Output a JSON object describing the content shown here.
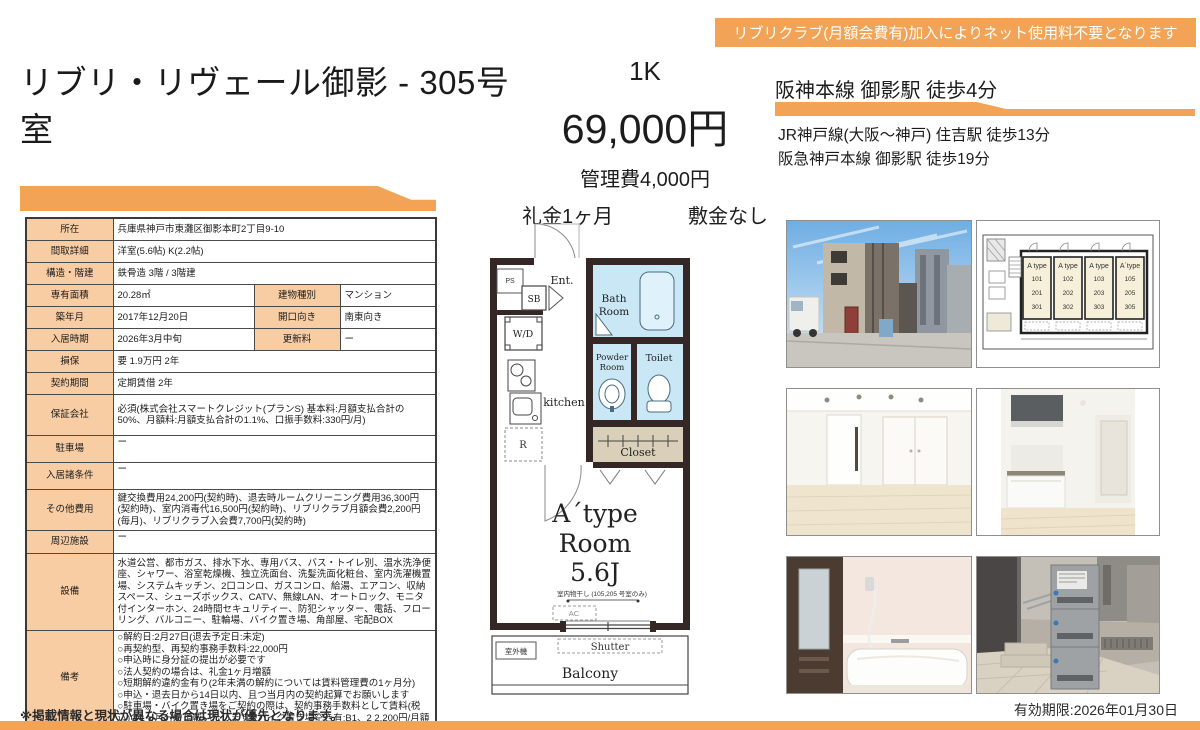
{
  "banner": {
    "text": "リブリクラブ(月額会費有)加入によりネット使用料不要となります"
  },
  "header": {
    "title": "リブリ・リヴェール御影 - 305号室",
    "layout_type": "1K",
    "rent": "69,000円",
    "management_fee": "管理費4,000円",
    "key_money": "礼金1ヶ月",
    "deposit": "敷金なし",
    "access_main": "阪神本線 御影駅 徒歩4分",
    "access_sub": [
      "JR神戸線(大阪〜神戸) 住吉駅 徒歩13分",
      "阪急神戸本線 御影駅 徒歩19分"
    ]
  },
  "table": {
    "rows": [
      {
        "label": "所在",
        "value": "兵庫県神戸市東灘区御影本町2丁目9-10"
      },
      {
        "label": "間取詳細",
        "value": "洋室(5.6帖) K(2.2帖)"
      },
      {
        "label": "構造・階建",
        "value": "鉄骨造 3階 / 3階建"
      },
      {
        "label": "専有面積",
        "value": "20.28㎡",
        "label2": "建物種別",
        "value2": "マンション"
      },
      {
        "label": "築年月",
        "value": "2017年12月20日",
        "label2": "開口向き",
        "value2": "南東向き"
      },
      {
        "label": "入居時期",
        "value": "2026年3月中旬",
        "label2": "更新料",
        "value2": "ー"
      },
      {
        "label": "損保",
        "value": "要 1.9万円 2年"
      },
      {
        "label": "契約期間",
        "value": "定期賃借 2年"
      },
      {
        "label": "保証会社",
        "value": "必須(株式会社スマートクレジット(プランS) 基本料:月額支払合計の50%、月額料:月額支払合計の1.1%、口振手数料:330円/月)"
      },
      {
        "label": "駐車場",
        "value": "ー"
      },
      {
        "label": "入居諸条件",
        "value": "ー"
      },
      {
        "label": "その他費用",
        "value": "鍵交換費用24,200円(契約時)、退去時ルームクリーニング費用36,300円(契約時)、室内消毒代16,500円(契約時)、リブリクラブ月額会費2,200円(毎月)、リブリクラブ入会費7,700円(契約時)"
      },
      {
        "label": "周辺施設",
        "value": "ー"
      },
      {
        "label": "設備",
        "value": "水道公営、都市ガス、排水下水、専用バス、バス・トイレ別、温水洗浄便座、シャワー、浴室乾燥機、独立洗面台、洗髪洗面化粧台、室内洗濯機置場、システムキッチン、2口コンロ、ガスコンロ、給湯、エアコン、収納スペース、シューズボックス、CATV、無線LAN、オートロック、モニタ付インターホン、24時間セキュリティー、防犯シャッター、電話、フローリング、バルコニー、駐輪場、バイク置き場、角部屋、宅配BOX"
      },
      {
        "label": "備考",
        "value": "○解約日:2月27日(退去予定日:未定)\n○再契約型、再契約事務手数料:22,000円\n○申込時に身分証の提出が必要です\n○法人契約の場合は、礼金1ヶ月増額\n○短期解約違約金有り(2年未満の解約については賃料管理費の1ヶ月分)\n○申込・退去日から14日以内、且つ当月内の契約起算でお願いします\n○駐車場・バイク置き場をご契約の際は、契約事務手数料として賃料(税込)の1ヶ月分を頂戴いたします※バイク置き場空き有:B1、2 2,200円/月額"
      }
    ]
  },
  "floorplan": {
    "ent": "Ent.",
    "ps": "PS",
    "sb": "SB",
    "wd": "W/D",
    "kitchen": "kitchen",
    "fridge": "R",
    "bath_line1": "Bath",
    "bath_line2": "Room",
    "powder_line1": "Powder",
    "powder_line2": "Room",
    "toilet": "Toilet",
    "closet": "Closet",
    "room_type": "A´type",
    "room_word": "Room",
    "room_size": "5.6J",
    "drying_note": "室内物干し (105,205 号室のみ)",
    "ac": "AC",
    "shutter": "Shutter",
    "outdoor_unit": "室外機",
    "balcony": "Balcony"
  },
  "siteplan": {
    "units": [
      {
        "type": "A type",
        "rooms": [
          "101",
          "201",
          "301"
        ]
      },
      {
        "type": "A type",
        "rooms": [
          "102",
          "202",
          "302"
        ]
      },
      {
        "type": "A type",
        "rooms": [
          "103",
          "203",
          "303"
        ]
      },
      {
        "type": "A´type",
        "rooms": [
          "105",
          "205",
          "305"
        ]
      }
    ]
  },
  "footer": {
    "disclaimer": "※掲載情報と現状が異なる場合は現状が優先となります。",
    "expiry": "有効期限:2026年01月30日"
  },
  "colors": {
    "accent_orange": "#F2A355",
    "table_label_bg": "#F8CDA4",
    "bath_blue": "#C9E7F4",
    "closet_tan": "#DACFB9",
    "wall_brown": "#362727"
  }
}
